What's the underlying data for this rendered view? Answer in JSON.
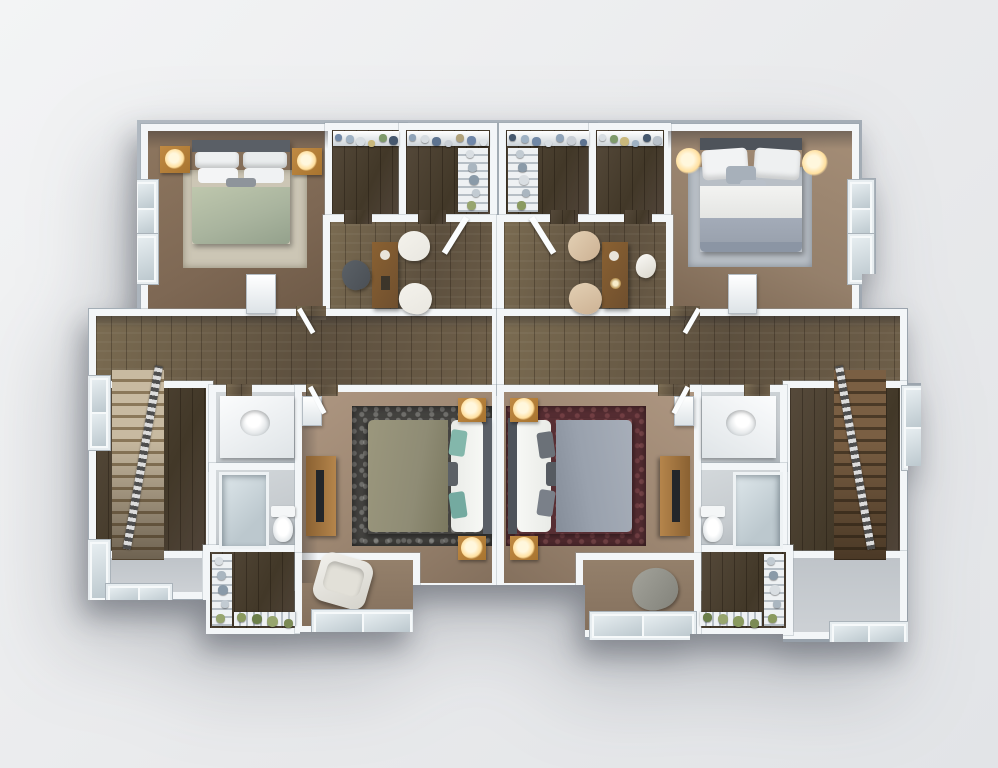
{
  "scene": {
    "type": "3d-floor-plan-rendering",
    "description": "Top-down 3D rendering of a mirrored two-unit upper floor: two front bedrooms, walk-in closets, loft/office areas, two master bedrooms, bathrooms and twin staircases"
  },
  "palette": {
    "bg1": "#f3f4f5",
    "bg2": "#e9eaec",
    "bg3": "#e2e4e7",
    "shell-edge": "#a0a9b2",
    "wall-white": "#f3f6f8",
    "tile": "#c6cbcf",
    "landing": "#cdd1d5",
    "glass": "#bcc8ce",
    "shelf": "#eef1f3",
    "carpet-tl": "#7e6854",
    "carpet-tr": "#95806b",
    "carpet-m": "#9b8570",
    "rug-tl": "#ccc6b5",
    "rug-tr": "#b9bfc6",
    "rug-ml": "#454441",
    "rug-mr": "#572e33",
    "sage": "#a9b49e",
    "olive": "#8f8c75",
    "bedgray": "#99a1ad",
    "headboard": "#5a5f66",
    "nwood": "#a8742f",
    "glow": "#ffdf9e",
    "deskwood": "#6f4f2e",
    "chair-dark": "#4a4f55",
    "chair-white": "#e9e7e0",
    "chair-tan": "#ccb193",
    "stairL1": "#c8baa1",
    "stairR1": "#7a5f43",
    "teal": "#83b7ab"
  },
  "decor": {
    "rodL1": {
      "n": 6,
      "size": 7,
      "colors": [
        "#7188a6",
        "#9fb2c4",
        "#d7dde2",
        "#c9b87c",
        "#7e9a6b",
        "#46586e"
      ]
    },
    "rodL2": {
      "n": 7,
      "size": 7,
      "colors": [
        "#8fa3b8",
        "#d7dde2",
        "#5d7390",
        "#c9cfd6",
        "#b0a17a",
        "#6f86a8",
        "#dfe4e8"
      ]
    },
    "rodR1": {
      "n": 7,
      "size": 7,
      "colors": [
        "#46586e",
        "#9fb2c4",
        "#7188a6",
        "#d7dde2",
        "#8fa3b8",
        "#c9cfd6",
        "#5d7390"
      ]
    },
    "rodR2": {
      "n": 6,
      "size": 7,
      "colors": [
        "#d7dde2",
        "#7e9a6b",
        "#c9b87c",
        "#9fb2c4",
        "#46586e",
        "#b9c2cb"
      ]
    },
    "rackL": {
      "n": 5,
      "size": 8,
      "colors": [
        "#d9dee2",
        "#aab6c0",
        "#8a9aa8",
        "#c2cbd2",
        "#97a56e"
      ]
    },
    "rackR": {
      "n": 5,
      "size": 8,
      "colors": [
        "#c2cbd2",
        "#8a9aa8",
        "#d9dee2",
        "#aab6c0",
        "#8a9a5f"
      ]
    },
    "plantsL": {
      "n": 4,
      "size": 9,
      "colors": [
        "#8a9a5f",
        "#6c7f4a",
        "#97a56e",
        "#7b8a55"
      ]
    },
    "plantsR": {
      "n": 4,
      "size": 9,
      "colors": [
        "#6c7f4a",
        "#97a56e",
        "#8a9a5f",
        "#7b8a55"
      ]
    }
  }
}
